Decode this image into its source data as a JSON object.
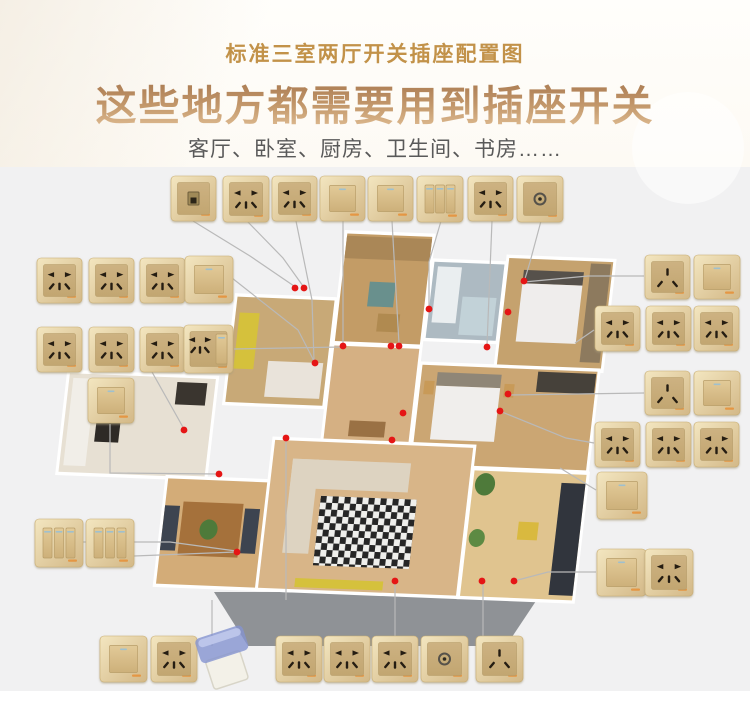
{
  "header": {
    "small_title": "标准三室两厅开关插座配置图",
    "big_title": "这些地方都需要用到插座开关",
    "subtitle": "客厅、卧室、厨房、卫生间、书房……",
    "small_color": "#c29249",
    "subtitle_color": "#595959"
  },
  "palette": {
    "plate_gold_light": "#f1e3bb",
    "plate_gold_dark": "#d3b887",
    "plate_inner": "#c9ae7c",
    "hole": "#251d12",
    "indicator": "#9fc0ce",
    "brand_mark": "#e8882a",
    "line": "#b9b9b9",
    "dot": "#e51515",
    "platform": "#8f9296",
    "wall": "#ffffff",
    "cover_blue": "#8494cf"
  },
  "plates": [
    {
      "type": "net",
      "x": 171,
      "y": 176,
      "w": 45,
      "h": 45
    },
    {
      "type": "socket5",
      "x": 223,
      "y": 176,
      "w": 46,
      "h": 46
    },
    {
      "type": "socket5",
      "x": 272,
      "y": 176,
      "w": 45,
      "h": 45
    },
    {
      "type": "switch1",
      "x": 320,
      "y": 176,
      "w": 45,
      "h": 45
    },
    {
      "type": "switch1",
      "x": 368,
      "y": 176,
      "w": 45,
      "h": 45
    },
    {
      "type": "switch3",
      "x": 417,
      "y": 176,
      "w": 46,
      "h": 46
    },
    {
      "type": "socket5",
      "x": 468,
      "y": 176,
      "w": 45,
      "h": 45
    },
    {
      "type": "tv",
      "x": 517,
      "y": 176,
      "w": 46,
      "h": 46
    },
    {
      "type": "socket5",
      "x": 37,
      "y": 258,
      "w": 45,
      "h": 45
    },
    {
      "type": "socket5",
      "x": 89,
      "y": 258,
      "w": 45,
      "h": 45
    },
    {
      "type": "socket5",
      "x": 140,
      "y": 258,
      "w": 45,
      "h": 45
    },
    {
      "type": "switch1",
      "x": 185,
      "y": 256,
      "w": 48,
      "h": 47
    },
    {
      "type": "socket5",
      "x": 37,
      "y": 327,
      "w": 45,
      "h": 45
    },
    {
      "type": "socket5",
      "x": 89,
      "y": 327,
      "w": 45,
      "h": 45
    },
    {
      "type": "socket5",
      "x": 140,
      "y": 327,
      "w": 45,
      "h": 45
    },
    {
      "type": "combo",
      "x": 184,
      "y": 325,
      "w": 49,
      "h": 48
    },
    {
      "type": "switch1",
      "x": 88,
      "y": 378,
      "w": 46,
      "h": 45
    },
    {
      "type": "switch3",
      "x": 35,
      "y": 519,
      "w": 48,
      "h": 48
    },
    {
      "type": "switch3",
      "x": 86,
      "y": 519,
      "w": 48,
      "h": 48
    },
    {
      "type": "socket3",
      "x": 645,
      "y": 255,
      "w": 45,
      "h": 44
    },
    {
      "type": "switch1",
      "x": 694,
      "y": 255,
      "w": 46,
      "h": 44
    },
    {
      "type": "socket5",
      "x": 595,
      "y": 306,
      "w": 45,
      "h": 45
    },
    {
      "type": "socket5",
      "x": 646,
      "y": 306,
      "w": 45,
      "h": 45
    },
    {
      "type": "socket5",
      "x": 694,
      "y": 306,
      "w": 45,
      "h": 45
    },
    {
      "type": "socket3",
      "x": 645,
      "y": 371,
      "w": 45,
      "h": 44
    },
    {
      "type": "switch1",
      "x": 694,
      "y": 371,
      "w": 46,
      "h": 44
    },
    {
      "type": "socket5",
      "x": 595,
      "y": 422,
      "w": 45,
      "h": 45
    },
    {
      "type": "socket5",
      "x": 646,
      "y": 422,
      "w": 45,
      "h": 45
    },
    {
      "type": "socket5",
      "x": 694,
      "y": 422,
      "w": 45,
      "h": 45
    },
    {
      "type": "switch1",
      "x": 597,
      "y": 472,
      "w": 50,
      "h": 47
    },
    {
      "type": "switch1",
      "x": 597,
      "y": 549,
      "w": 49,
      "h": 47
    },
    {
      "type": "socket5",
      "x": 645,
      "y": 549,
      "w": 48,
      "h": 47
    },
    {
      "type": "switch1",
      "x": 100,
      "y": 636,
      "w": 47,
      "h": 46
    },
    {
      "type": "socket5",
      "x": 151,
      "y": 636,
      "w": 46,
      "h": 46
    },
    {
      "type": "cover",
      "x": 197,
      "y": 628,
      "w": 62,
      "h": 58
    },
    {
      "type": "socket5",
      "x": 276,
      "y": 636,
      "w": 46,
      "h": 46
    },
    {
      "type": "socket5",
      "x": 324,
      "y": 636,
      "w": 46,
      "h": 46
    },
    {
      "type": "socket5",
      "x": 372,
      "y": 636,
      "w": 46,
      "h": 46
    },
    {
      "type": "tv",
      "x": 421,
      "y": 636,
      "w": 47,
      "h": 46
    },
    {
      "type": "socket3",
      "x": 476,
      "y": 636,
      "w": 47,
      "h": 46
    }
  ],
  "dots": [
    [
      295,
      288
    ],
    [
      304,
      288
    ],
    [
      343,
      346
    ],
    [
      315,
      363
    ],
    [
      391,
      346
    ],
    [
      399,
      346
    ],
    [
      429,
      309
    ],
    [
      524,
      281
    ],
    [
      508,
      312
    ],
    [
      487,
      347
    ],
    [
      403,
      413
    ],
    [
      500,
      411
    ],
    [
      508,
      394
    ],
    [
      184,
      430
    ],
    [
      219,
      474
    ],
    [
      286,
      438
    ],
    [
      392,
      440
    ],
    [
      237,
      552
    ],
    [
      395,
      581
    ],
    [
      482,
      581
    ],
    [
      514,
      581
    ]
  ],
  "lines": [
    [
      [
        193,
        221
      ],
      [
        250,
        256
      ],
      [
        294,
        286
      ]
    ],
    [
      [
        247,
        221
      ],
      [
        283,
        258
      ],
      [
        303,
        286
      ]
    ],
    [
      [
        296,
        221
      ],
      [
        312,
        300
      ],
      [
        314,
        361
      ]
    ],
    [
      [
        343,
        221
      ],
      [
        343,
        344
      ]
    ],
    [
      [
        392,
        221
      ],
      [
        399,
        344
      ]
    ],
    [
      [
        441,
        221
      ],
      [
        429,
        262
      ],
      [
        429,
        307
      ]
    ],
    [
      [
        492,
        221
      ],
      [
        487,
        345
      ]
    ],
    [
      [
        541,
        221
      ],
      [
        530,
        262
      ],
      [
        524,
        282
      ]
    ],
    [
      [
        524,
        282
      ],
      [
        588,
        276
      ],
      [
        644,
        276
      ]
    ],
    [
      [
        232,
        278
      ],
      [
        298,
        330
      ],
      [
        314,
        361
      ]
    ],
    [
      [
        234,
        349
      ],
      [
        341,
        347
      ]
    ],
    [
      [
        152,
        372
      ],
      [
        184,
        429
      ]
    ],
    [
      [
        110,
        424
      ],
      [
        110,
        473
      ],
      [
        218,
        474
      ]
    ],
    [
      [
        83,
        542
      ],
      [
        170,
        542
      ],
      [
        236,
        551
      ]
    ],
    [
      [
        134,
        556
      ],
      [
        236,
        552
      ]
    ],
    [
      [
        286,
        440
      ],
      [
        286,
        600
      ]
    ],
    [
      [
        212,
        600
      ],
      [
        212,
        646
      ]
    ],
    [
      [
        395,
        584
      ],
      [
        395,
        646
      ]
    ],
    [
      [
        483,
        584
      ],
      [
        483,
        646
      ]
    ],
    [
      [
        575,
        343
      ],
      [
        594,
        330
      ]
    ],
    [
      [
        509,
        395
      ],
      [
        644,
        393
      ]
    ],
    [
      [
        560,
        468
      ],
      [
        596,
        490
      ]
    ],
    [
      [
        514,
        581
      ],
      [
        548,
        572
      ],
      [
        596,
        572
      ]
    ],
    [
      [
        502,
        412
      ],
      [
        566,
        438
      ],
      [
        594,
        443
      ]
    ]
  ],
  "floorplan": {
    "transform": "matrix(1,0.04,-0.13,1.12,253,250)",
    "platform": [
      [
        214,
        592
      ],
      [
        542,
        592
      ],
      [
        506,
        646
      ],
      [
        248,
        646
      ]
    ],
    "rooms": [
      {
        "name": "study",
        "x": -10,
        "y": 42,
        "w": 97,
        "h": 94,
        "c": "#c8a977"
      },
      {
        "name": "bedroom-top",
        "x": 92,
        "y": -18,
        "w": 85,
        "h": 96,
        "c": "#c39c66"
      },
      {
        "name": "bathroom",
        "x": 182,
        "y": 4,
        "w": 70,
        "h": 68,
        "c": "#adbac2"
      },
      {
        "name": "master-bedroom",
        "x": 256,
        "y": -2,
        "w": 104,
        "h": 96,
        "c": "#c5a26e"
      },
      {
        "name": "hallway",
        "x": 92,
        "y": 82,
        "w": 85,
        "h": 84,
        "c": "#d5b083"
      },
      {
        "name": "bedroom-right",
        "x": 182,
        "y": 96,
        "w": 175,
        "h": 88,
        "c": "#cba673"
      },
      {
        "name": "kitchen",
        "x": -168,
        "y": 116,
        "w": 146,
        "h": 88,
        "c": "#e7e0d3"
      },
      {
        "name": "dining",
        "x": -58,
        "y": 206,
        "w": 134,
        "h": 94,
        "c": "#d3ac78"
      },
      {
        "name": "living",
        "x": 44,
        "y": 168,
        "w": 198,
        "h": 132,
        "c": "#d8b588"
      },
      {
        "name": "balcony",
        "x": 246,
        "y": 188,
        "w": 112,
        "h": 112,
        "c": "#e0c48f"
      }
    ],
    "furniture": [
      {
        "n": "curtain",
        "k": "r",
        "x": 92,
        "y": -16,
        "w": 85,
        "h": 20,
        "c": "#aa8757"
      },
      {
        "n": "armchair",
        "k": "r",
        "x": 120,
        "y": 24,
        "w": 26,
        "h": 22,
        "c": "#69908d"
      },
      {
        "n": "side-table",
        "k": "r",
        "x": 132,
        "y": 52,
        "w": 22,
        "h": 16,
        "c": "#b08a50"
      },
      {
        "n": "study-desk",
        "k": "r",
        "x": -6,
        "y": 56,
        "w": 20,
        "h": 50,
        "c": "#d5c13c"
      },
      {
        "n": "study-bed",
        "k": "r",
        "x": 28,
        "y": 98,
        "w": 55,
        "h": 32,
        "c": "#e9e3da"
      },
      {
        "n": "bathtub",
        "k": "r",
        "x": 186,
        "y": 8,
        "w": 24,
        "h": 50,
        "c": "#eaeef0"
      },
      {
        "n": "shower-glass",
        "k": "r",
        "x": 214,
        "y": 34,
        "w": 34,
        "h": 34,
        "c": "#c2d2d8"
      },
      {
        "n": "master-headboard",
        "k": "r",
        "x": 272,
        "y": 8,
        "w": 60,
        "h": 12,
        "c": "#56514b"
      },
      {
        "n": "master-bed",
        "k": "r",
        "x": 272,
        "y": 20,
        "w": 60,
        "h": 52,
        "c": "#efedec"
      },
      {
        "n": "master-wardrobe",
        "k": "r",
        "x": 338,
        "y": 0,
        "w": 20,
        "h": 88,
        "c": "#8d7a5e"
      },
      {
        "n": "hall-door",
        "k": "r",
        "x": 116,
        "y": 148,
        "w": 36,
        "h": 14,
        "c": "#9a7144"
      },
      {
        "n": "bed2-headboard",
        "k": "r",
        "x": 198,
        "y": 102,
        "w": 64,
        "h": 12,
        "c": "#8f8677"
      },
      {
        "n": "bed2-bed",
        "k": "r",
        "x": 198,
        "y": 114,
        "w": 64,
        "h": 48,
        "c": "#f0eeec"
      },
      {
        "n": "nightstand-left",
        "k": "r",
        "x": 186,
        "y": 110,
        "w": 10,
        "h": 12,
        "c": "#c89a58"
      },
      {
        "n": "nightstand-right",
        "k": "r",
        "x": 266,
        "y": 110,
        "w": 10,
        "h": 12,
        "c": "#c89a58"
      },
      {
        "n": "bed2-closet",
        "k": "r",
        "x": 298,
        "y": 98,
        "w": 58,
        "h": 18,
        "c": "#46413a"
      },
      {
        "n": "kitchen-counter",
        "k": "r",
        "x": -164,
        "y": 120,
        "w": 22,
        "h": 78,
        "c": "#f1eee8"
      },
      {
        "n": "kitchen-stove",
        "k": "r",
        "x": -136,
        "y": 146,
        "w": 24,
        "h": 30,
        "c": "#2e2a26"
      },
      {
        "n": "fridge",
        "k": "r",
        "x": -60,
        "y": 120,
        "w": 30,
        "h": 20,
        "c": "#3a352f"
      },
      {
        "n": "dining-table",
        "k": "r",
        "x": -40,
        "y": 226,
        "w": 60,
        "h": 48,
        "c": "#a5713b"
      },
      {
        "n": "dining-chairs-left",
        "k": "r",
        "x": -58,
        "y": 230,
        "w": 15,
        "h": 40,
        "c": "#3d4450"
      },
      {
        "n": "dining-chairs-right",
        "k": "r",
        "x": 22,
        "y": 230,
        "w": 15,
        "h": 40,
        "c": "#3d4450"
      },
      {
        "n": "dining-plant",
        "k": "c",
        "cx": -12,
        "cy": 250,
        "r": 9,
        "c": "#4e7a3a"
      },
      {
        "n": "sofa-back",
        "k": "r",
        "x": 64,
        "y": 184,
        "w": 118,
        "h": 26,
        "c": "#ddd3c1"
      },
      {
        "n": "sofa-side",
        "k": "r",
        "x": 64,
        "y": 184,
        "w": 26,
        "h": 84,
        "c": "#ddd3c1"
      },
      {
        "n": "rug",
        "k": "r",
        "x": 96,
        "y": 216,
        "w": 96,
        "h": 62,
        "c": "url(#checker)"
      },
      {
        "n": "tv-bench",
        "k": "r",
        "x": 80,
        "y": 290,
        "w": 88,
        "h": 8,
        "c": "#d5c13c"
      },
      {
        "n": "balcony-plant-top",
        "k": "c",
        "cx": 258,
        "cy": 200,
        "r": 10,
        "c": "#4e7a3a"
      },
      {
        "n": "balcony-plant-mid",
        "k": "c",
        "cx": 256,
        "cy": 248,
        "r": 8,
        "c": "#5d8a43"
      },
      {
        "n": "balcony-chair",
        "k": "r",
        "x": 296,
        "y": 232,
        "w": 20,
        "h": 16,
        "c": "#d9b93f"
      },
      {
        "n": "balcony-shelf",
        "k": "r",
        "x": 334,
        "y": 196,
        "w": 24,
        "h": 100,
        "c": "#31353d"
      }
    ]
  }
}
